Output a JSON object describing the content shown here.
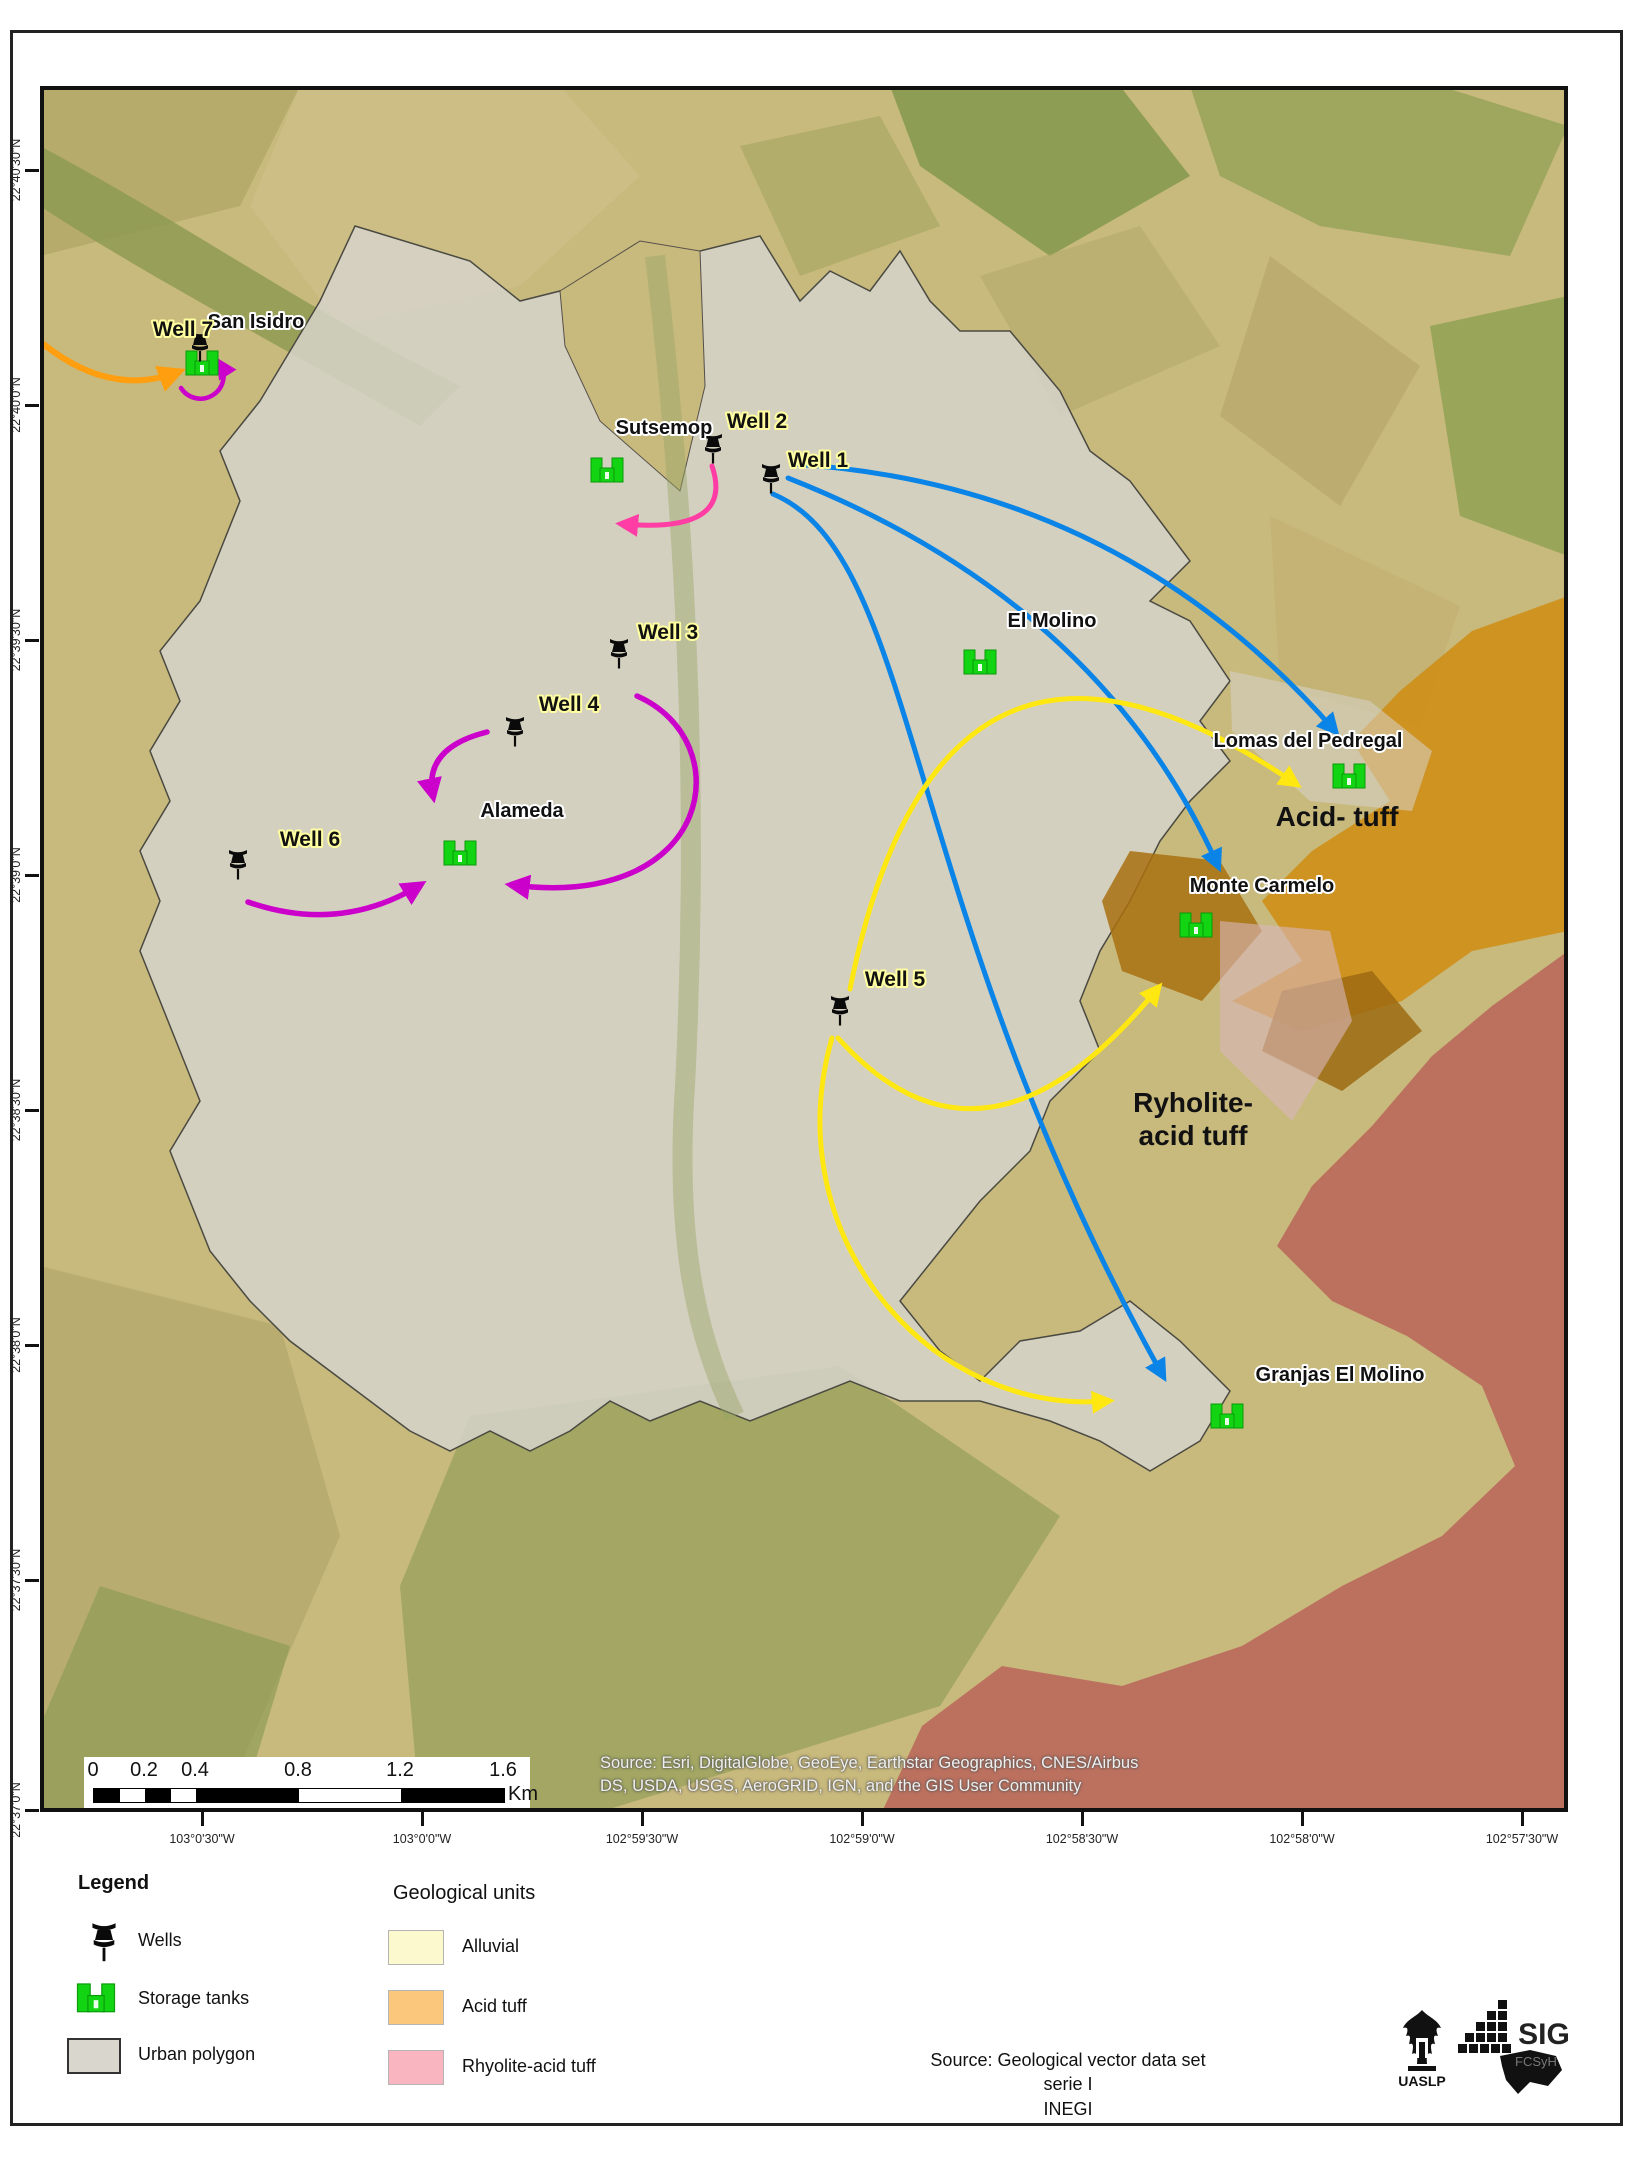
{
  "map": {
    "x_tick_labels": [
      "103°0'30\"W",
      "103°0'0\"W",
      "102°59'30\"W",
      "102°59'0\"W",
      "102°58'30\"W",
      "102°58'0\"W",
      "102°57'30\"W"
    ],
    "y_tick_labels": [
      "22°40'30\"N",
      "22°40'0\"N",
      "22°39'30\"N",
      "22°39'0\"N",
      "22°38'30\"N",
      "22°38'0\"N",
      "22°37'30\"N",
      "22°37'0\"N"
    ],
    "attribution_line1": "Source: Esri, DigitalGlobe, GeoEye, Earthstar Geographics, CNES/Airbus",
    "attribution_line2": "DS, USDA, USGS, AeroGRID, IGN, and the GIS User Community",
    "scalebar": {
      "ticks": [
        "0",
        "0.2",
        "0.4",
        "0.8",
        "1.2",
        "1.6"
      ],
      "unit": "Km"
    },
    "wells": [
      {
        "label": "Well 7",
        "pin": [
          160,
          262
        ],
        "label_pos": [
          143,
          250
        ]
      },
      {
        "label": "Well 2",
        "pin": [
          673,
          364
        ],
        "label_pos": [
          717,
          342
        ]
      },
      {
        "label": "Well 1",
        "pin": [
          731,
          394
        ],
        "label_pos": [
          778,
          381
        ]
      },
      {
        "label": "Well 3",
        "pin": [
          579,
          569
        ],
        "label_pos": [
          628,
          553
        ]
      },
      {
        "label": "Well 4",
        "pin": [
          475,
          647
        ],
        "label_pos": [
          529,
          625
        ]
      },
      {
        "label": "Well 6",
        "pin": [
          198,
          780
        ],
        "label_pos": [
          270,
          760
        ]
      },
      {
        "label": "Well 5",
        "pin": [
          800,
          926
        ],
        "label_pos": [
          855,
          900
        ]
      }
    ],
    "storage_tanks": [
      {
        "label": "San Isidro",
        "tank": [
          162,
          277
        ],
        "label_pos": [
          216,
          242
        ]
      },
      {
        "label": "Sutsemop",
        "tank": [
          567,
          384
        ],
        "label_pos": [
          624,
          348
        ]
      },
      {
        "label": "El Molino",
        "tank": [
          940,
          576
        ],
        "label_pos": [
          1012,
          541
        ]
      },
      {
        "label": "Alameda",
        "tank": [
          420,
          767
        ],
        "label_pos": [
          482,
          731
        ]
      },
      {
        "label": "Lomas del Pedregal",
        "tank": [
          1309,
          690
        ],
        "label_pos": [
          1268,
          661
        ]
      },
      {
        "label": "Monte Carmelo",
        "tank": [
          1156,
          839
        ],
        "label_pos": [
          1222,
          806
        ]
      },
      {
        "label": "Granjas El Molino",
        "tank": [
          1187,
          1330
        ],
        "label_pos": [
          1300,
          1295
        ]
      }
    ],
    "geology_labels": [
      {
        "lines": [
          "Acid- tuff"
        ],
        "pos": [
          1297,
          740
        ]
      },
      {
        "lines": [
          "Ryholite-",
          "acid tuff"
        ],
        "pos": [
          1153,
          1026
        ]
      }
    ],
    "flow_arrows": [
      {
        "name": "inflow-to-well7",
        "color": "orange",
        "width": 6,
        "path": "M 2,257 Q 70,312 138,286"
      },
      {
        "name": "well7-recirculation",
        "color": "magenta",
        "width": 4.5,
        "path": "M 141,302 A 22,22 0 1 0 180,277"
      },
      {
        "name": "well2-to-southwest",
        "color": "pink",
        "width": 5,
        "path": "M 672,380 Q 695,448 582,438"
      },
      {
        "name": "well1-to-lomas-del-pedregal",
        "color": "blue",
        "width": 5,
        "path": "M 752,378 Q 1080,398 1295,645"
      },
      {
        "name": "well1-to-monte-carmelo",
        "color": "blue",
        "width": 5,
        "path": "M 748,392 Q 1060,515 1178,780"
      },
      {
        "name": "well1-to-granjas-el-molino",
        "color": "blue",
        "width": 5,
        "path": "M 733,408 C 880,470 860,820 1123,1290"
      },
      {
        "name": "well5-to-lomas-del-pedregal",
        "color": "yellow",
        "width": 5,
        "path": "M 810,903 Q 900,455 1256,698"
      },
      {
        "name": "well5-to-rhyolite-area",
        "color": "yellow",
        "width": 5,
        "path": "M 798,952 Q 945,1115 1118,902"
      },
      {
        "name": "well5-to-granjas",
        "color": "yellow",
        "width": 5,
        "path": "M 792,952 C 735,1150 890,1330 1068,1315"
      },
      {
        "name": "well4-to-alameda",
        "color": "magenta",
        "width": 5.5,
        "path": "M 447,646 Q 383,662 393,710"
      },
      {
        "name": "well6-to-alameda",
        "color": "magenta",
        "width": 5.5,
        "path": "M 208,816 Q 300,848 380,799"
      },
      {
        "name": "well3-area-to-alameda",
        "color": "magenta",
        "width": 5.5,
        "path": "M 597,610 C 700,655 675,825 472,799"
      }
    ],
    "arrow_colors": {
      "blue": "#0a84e6",
      "yellow": "#ffe712",
      "magenta": "#cb00cb",
      "pink": "#ff3da4",
      "orange": "#ff9e0e"
    }
  },
  "legend": {
    "title": "Legend",
    "items": [
      {
        "icon": "well-pin",
        "label": "Wells"
      },
      {
        "icon": "storage-tank",
        "label": "Storage tanks"
      },
      {
        "icon": "urban-polygon",
        "label": "Urban polygon"
      }
    ],
    "geological": {
      "title": "Geological units",
      "items": [
        {
          "label": "Alluvial",
          "color": "#fcf9cf"
        },
        {
          "label": "Acid tuff",
          "color": "#fbc77d"
        },
        {
          "label": "Rhyolite-acid tuff",
          "color": "#f9b6c0"
        }
      ]
    }
  },
  "footer": {
    "source_lines": [
      "Source: Geological vector data set",
      "serie I",
      "INEGI"
    ],
    "logos": [
      {
        "name": "UASLP"
      },
      {
        "name": "SIG FCSyH"
      }
    ]
  },
  "colors": {
    "urban_polygon": "#d6d3ca",
    "fields_base": "#c8b97d",
    "acid_tuff_map": "#cf8c10",
    "rhyolite_map": "#b95f58"
  }
}
